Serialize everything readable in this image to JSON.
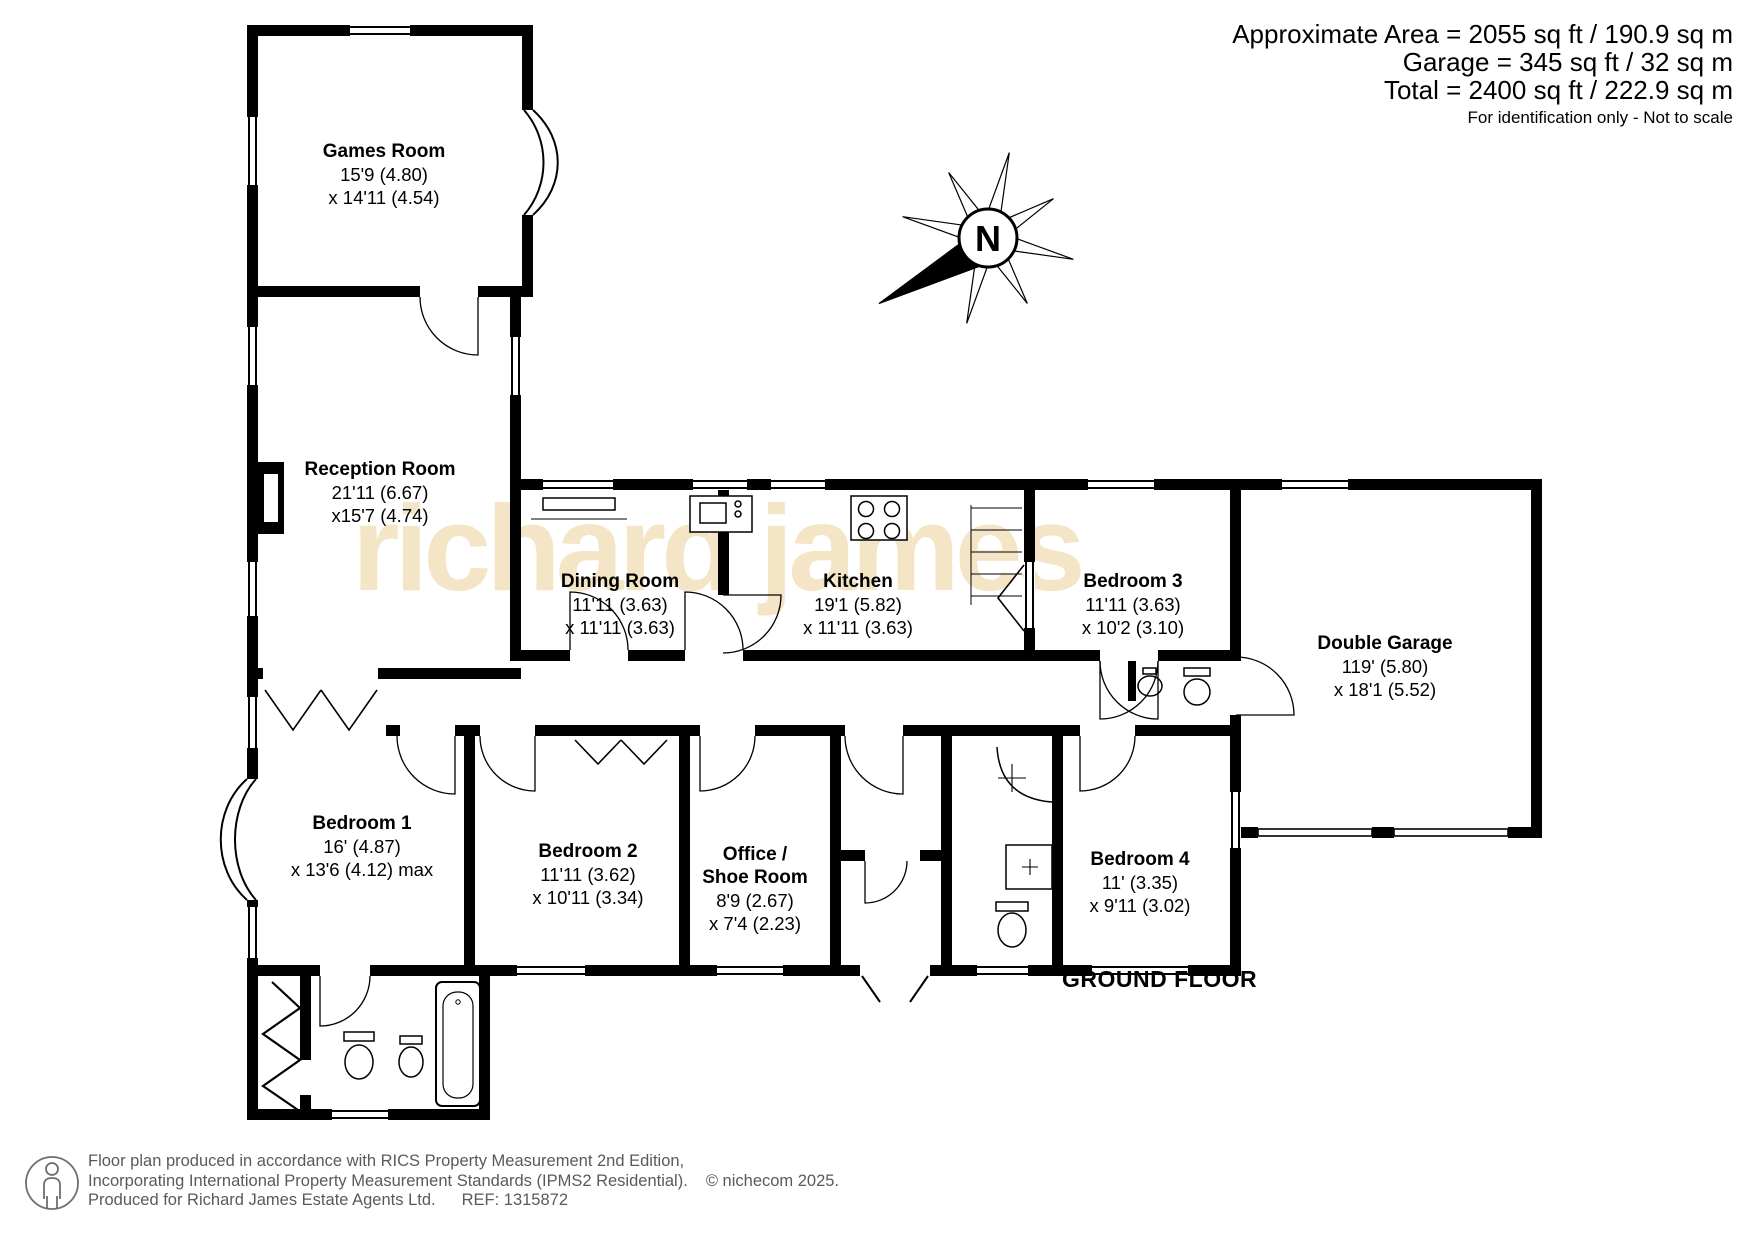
{
  "header": {
    "area_line": "Approximate Area = 2055 sq ft / 190.9 sq m",
    "garage_line": "Garage = 345 sq ft / 32 sq m",
    "total_line": "Total = 2400 sq ft / 222.9 sq m",
    "disclaimer": "For identification only - Not to scale"
  },
  "watermark": {
    "text": "richard james",
    "color": "#f3e5c5"
  },
  "compass": {
    "label": "N"
  },
  "floor_label": "GROUND FLOOR",
  "rooms": [
    {
      "id": "games-room",
      "name": "Games Room",
      "dim1": "15'9 (4.80)",
      "dim2": "x 14'11 (4.54)"
    },
    {
      "id": "reception-room",
      "name": "Reception Room",
      "dim1": "21'11 (6.67)",
      "dim2": "x15'7 (4.74)"
    },
    {
      "id": "dining-room",
      "name": "Dining Room",
      "dim1": "11'11 (3.63)",
      "dim2": "x 11'11 (3.63)"
    },
    {
      "id": "kitchen",
      "name": "Kitchen",
      "dim1": "19'1 (5.82)",
      "dim2": "x 11'11 (3.63)"
    },
    {
      "id": "bedroom-3",
      "name": "Bedroom 3",
      "dim1": "11'11 (3.63)",
      "dim2": "x 10'2 (3.10)"
    },
    {
      "id": "double-garage",
      "name": "Double Garage",
      "dim1": "119' (5.80)",
      "dim2": "x 18'1 (5.52)"
    },
    {
      "id": "bedroom-1",
      "name": "Bedroom 1",
      "dim1": "16' (4.87)",
      "dim2": "x 13'6 (4.12) max"
    },
    {
      "id": "bedroom-2",
      "name": "Bedroom 2",
      "dim1": "11'11 (3.62)",
      "dim2": "x 10'11 (3.34)"
    },
    {
      "id": "office-shoe-room",
      "name": "Office /",
      "name2": "Shoe Room",
      "dim1": "8'9 (2.67)",
      "dim2": "x 7'4 (2.23)"
    },
    {
      "id": "bedroom-4",
      "name": "Bedroom 4",
      "dim1": "11' (3.35)",
      "dim2": "x 9'11 (3.02)"
    }
  ],
  "footer": {
    "line1": "Floor plan produced in accordance with RICS Property Measurement 2nd Edition,",
    "line2": "Incorporating International Property Measurement Standards (IPMS2 Residential).",
    "copyright": "© nichecom 2025.",
    "line3": "Produced for Richard James Estate Agents Ltd.",
    "ref": "REF: 1315872"
  },
  "colors": {
    "wall": "#000000",
    "footer_text": "#595a5c"
  }
}
